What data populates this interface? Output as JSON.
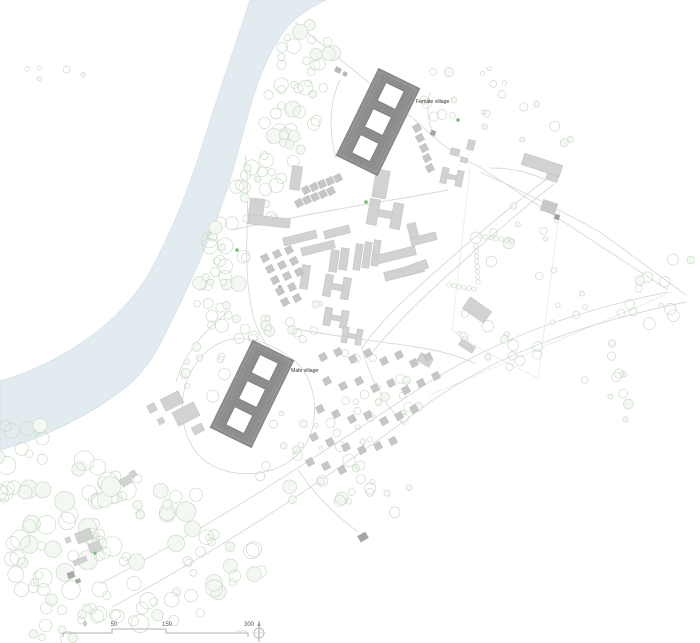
{
  "labels": {
    "female_village": "Female village",
    "male_village": "Male village"
  },
  "label_positions": {
    "female_village": {
      "x": 416,
      "y": 103
    },
    "male_village": {
      "x": 291,
      "y": 372
    }
  },
  "colors": {
    "water": "#e2ebef",
    "water_edge": "#d4e2e8",
    "tree": "#cbdcc8",
    "tree_fill": "#f4f8f2",
    "building": "#d2d2d2",
    "building_edge": "#bfbfbf",
    "hut": "#c6c6c6",
    "village": "#8d8d8d",
    "village_edge": "#7c7c7c",
    "village_inner": "#a3a3a3",
    "courtyard": "#ffffff",
    "road": "#d9d9d9",
    "faint": "#e9e9e9",
    "label_text": "#2e2e2e",
    "scale_text": "#555555",
    "scale_line": "#9a9a9a",
    "north": "#909090",
    "accent_green": "#6fbf6f"
  },
  "scale_bar": {
    "labels": [
      {
        "text": "0",
        "x": 85
      },
      {
        "text": "50",
        "x": 114
      },
      {
        "text": "150",
        "x": 167
      },
      {
        "text": "300",
        "x": 249
      }
    ],
    "label_y": 626,
    "path": "M63,637 L63,633 L112,633 L112,629 L166,629 L166,633 L248,633 L248,637",
    "dash": "M236,631 L247,631"
  },
  "north_arrow": {
    "cx": 259,
    "cy": 633,
    "r": 5
  },
  "map": {
    "water_path": "M250,0 C239,35 222,82 204,140 C188,192 172,230 152,268 C130,308 96,336 60,356 C38,368 18,376 0,381 L0,450 C45,438 90,415 125,388 C152,366 162,340 176,312 C196,270 214,232 230,180 C245,132 252,82 278,40 C288,24 300,12 326,0 Z",
    "villages": [
      {
        "id": "female-village-building",
        "cx": 378,
        "cy": 122,
        "w": 46,
        "h": 97,
        "rot": 26
      },
      {
        "id": "male-village-building",
        "cx": 252,
        "cy": 394,
        "w": 46,
        "h": 97,
        "rot": 26
      }
    ],
    "buildings": [
      {
        "s": "rect",
        "x": 381,
        "y": 184,
        "w": 14,
        "h": 28,
        "r": 10
      },
      {
        "s": "h",
        "x": 385,
        "y": 214,
        "w": 34,
        "h": 26,
        "r": 10
      },
      {
        "s": "l",
        "x": 270,
        "y": 213,
        "w": 42,
        "h": 26,
        "r": 6
      },
      {
        "s": "rect",
        "x": 296,
        "y": 178,
        "w": 10,
        "h": 24,
        "r": 8
      },
      {
        "s": "rect",
        "x": 300,
        "y": 238,
        "w": 34,
        "h": 8,
        "r": -14
      },
      {
        "s": "rect",
        "x": 318,
        "y": 248,
        "w": 34,
        "h": 8,
        "r": -14
      },
      {
        "s": "rect",
        "x": 337,
        "y": 232,
        "w": 26,
        "h": 8,
        "r": -14
      },
      {
        "s": "rect",
        "x": 334,
        "y": 261,
        "w": 8,
        "h": 22,
        "r": 8
      },
      {
        "s": "rect",
        "x": 344,
        "y": 259,
        "w": 8,
        "h": 22,
        "r": 8
      },
      {
        "s": "rect",
        "x": 358,
        "y": 257,
        "w": 7,
        "h": 26,
        "r": 8
      },
      {
        "s": "rect",
        "x": 367,
        "y": 255,
        "w": 7,
        "h": 26,
        "r": 8
      },
      {
        "s": "rect",
        "x": 376,
        "y": 253,
        "w": 7,
        "h": 26,
        "r": 8
      },
      {
        "s": "rect",
        "x": 396,
        "y": 255,
        "w": 40,
        "h": 9,
        "r": -14
      },
      {
        "s": "rect",
        "x": 404,
        "y": 272,
        "w": 40,
        "h": 9,
        "r": -14
      },
      {
        "s": "l",
        "x": 422,
        "y": 232,
        "w": 26,
        "h": 22,
        "r": -14
      },
      {
        "s": "rect",
        "x": 415,
        "y": 268,
        "w": 26,
        "h": 9,
        "r": -20
      },
      {
        "s": "h",
        "x": 337,
        "y": 287,
        "w": 26,
        "h": 22,
        "r": 10
      },
      {
        "s": "h",
        "x": 336,
        "y": 318,
        "w": 24,
        "h": 18,
        "r": 10
      },
      {
        "s": "rect",
        "x": 305,
        "y": 277,
        "w": 8,
        "h": 24,
        "r": 8
      },
      {
        "s": "h",
        "x": 352,
        "y": 336,
        "w": 20,
        "h": 16,
        "r": 10
      },
      {
        "s": "rect",
        "x": 425,
        "y": 360,
        "w": 14,
        "h": 9,
        "r": 30
      },
      {
        "s": "rect",
        "x": 477,
        "y": 310,
        "w": 26,
        "h": 14,
        "r": 35
      },
      {
        "s": "rect",
        "x": 467,
        "y": 346,
        "w": 16,
        "h": 7,
        "r": 32
      },
      {
        "s": "rect",
        "x": 172,
        "y": 401,
        "w": 20,
        "h": 13,
        "r": -27
      },
      {
        "s": "rect",
        "x": 186,
        "y": 414,
        "w": 24,
        "h": 15,
        "r": -27
      },
      {
        "s": "rect",
        "x": 152,
        "y": 408,
        "w": 8,
        "h": 8,
        "r": -27
      },
      {
        "s": "rect",
        "x": 198,
        "y": 429,
        "w": 11,
        "h": 8,
        "r": -27
      },
      {
        "s": "rect",
        "x": 161,
        "y": 421,
        "w": 6,
        "h": 6,
        "r": -27
      },
      {
        "s": "rect",
        "x": 126,
        "y": 481,
        "w": 11,
        "h": 8,
        "r": -30
      },
      {
        "s": "rect",
        "x": 133,
        "y": 474,
        "w": 6,
        "h": 6,
        "r": -30
      },
      {
        "s": "rect",
        "x": 84,
        "y": 536,
        "w": 16,
        "h": 11,
        "r": -22
      },
      {
        "s": "rect",
        "x": 95,
        "y": 547,
        "w": 12,
        "h": 9,
        "r": -22
      },
      {
        "s": "rect",
        "x": 68,
        "y": 540,
        "w": 5,
        "h": 5,
        "r": -22
      },
      {
        "s": "rect",
        "x": 80,
        "y": 561,
        "w": 14,
        "h": 5,
        "r": -22
      },
      {
        "s": "rect",
        "x": 71,
        "y": 575,
        "w": 7,
        "h": 6,
        "r": -20,
        "f": "#a8a8a8"
      },
      {
        "s": "rect",
        "x": 78,
        "y": 581,
        "w": 5,
        "h": 4,
        "r": -20,
        "f": "#a8a8a8"
      },
      {
        "s": "rect",
        "x": 363,
        "y": 537,
        "w": 9,
        "h": 7,
        "r": -30,
        "f": "#a3a3a3"
      },
      {
        "s": "h",
        "x": 452,
        "y": 177,
        "w": 22,
        "h": 16,
        "r": 12
      },
      {
        "s": "rect",
        "x": 455,
        "y": 152,
        "w": 9,
        "h": 7,
        "r": 15
      },
      {
        "s": "rect",
        "x": 464,
        "y": 160,
        "w": 7,
        "h": 5,
        "r": 15
      },
      {
        "s": "rect",
        "x": 471,
        "y": 145,
        "w": 7,
        "h": 10,
        "r": 15
      },
      {
        "s": "rect",
        "x": 542,
        "y": 165,
        "w": 40,
        "h": 12,
        "r": 18
      },
      {
        "s": "rect",
        "x": 552,
        "y": 178,
        "w": 12,
        "h": 6,
        "r": 18
      },
      {
        "s": "rect",
        "x": 549,
        "y": 207,
        "w": 15,
        "h": 11,
        "r": 18,
        "f": "#c8c8c8"
      },
      {
        "s": "rect",
        "x": 557,
        "y": 217,
        "w": 5,
        "h": 5,
        "r": 18,
        "f": "#9e9e9e"
      },
      {
        "s": "rect",
        "x": 433,
        "y": 133,
        "w": 5,
        "h": 5,
        "r": 20,
        "f": "#a5a5a5"
      },
      {
        "s": "rect",
        "x": 338,
        "y": 70,
        "w": 6,
        "h": 5,
        "r": 26,
        "f": "#b8b8b8"
      },
      {
        "s": "rect",
        "x": 345,
        "y": 74,
        "w": 4,
        "h": 4,
        "r": 26,
        "f": "#b8b8b8"
      }
    ],
    "hut_size": 7,
    "hut_rot": -28,
    "huts": [
      [
        306,
        190
      ],
      [
        314,
        187
      ],
      [
        322,
        184
      ],
      [
        330,
        181
      ],
      [
        338,
        178
      ],
      [
        299,
        203
      ],
      [
        307,
        200
      ],
      [
        315,
        197
      ],
      [
        323,
        194
      ],
      [
        331,
        191
      ],
      [
        265,
        258
      ],
      [
        270,
        269
      ],
      [
        275,
        280
      ],
      [
        280,
        291
      ],
      [
        285,
        302
      ],
      [
        277,
        254
      ],
      [
        282,
        265
      ],
      [
        287,
        276
      ],
      [
        292,
        287
      ],
      [
        297,
        298
      ],
      [
        289,
        250
      ],
      [
        294,
        261
      ],
      [
        299,
        272
      ],
      [
        417,
        128
      ],
      [
        420,
        138
      ],
      [
        424,
        148
      ],
      [
        427,
        158
      ],
      [
        430,
        168
      ],
      [
        323,
        357
      ],
      [
        338,
        352
      ],
      [
        353,
        359
      ],
      [
        368,
        353
      ],
      [
        384,
        361
      ],
      [
        399,
        355
      ],
      [
        414,
        363
      ],
      [
        428,
        357
      ],
      [
        327,
        381
      ],
      [
        343,
        386
      ],
      [
        359,
        381
      ],
      [
        375,
        388
      ],
      [
        391,
        383
      ],
      [
        406,
        390
      ],
      [
        421,
        383
      ],
      [
        436,
        376
      ],
      [
        320,
        409
      ],
      [
        336,
        414
      ],
      [
        352,
        419
      ],
      [
        368,
        415
      ],
      [
        384,
        421
      ],
      [
        399,
        416
      ],
      [
        414,
        409
      ],
      [
        314,
        437
      ],
      [
        330,
        442
      ],
      [
        346,
        447
      ],
      [
        362,
        450
      ],
      [
        378,
        446
      ],
      [
        393,
        441
      ],
      [
        310,
        462
      ],
      [
        326,
        466
      ],
      [
        342,
        470
      ]
    ],
    "tree_clusters": [
      [
        312,
        62,
        34,
        40,
        22,
        3,
        8
      ],
      [
        288,
        122,
        30,
        40,
        22,
        3,
        8
      ],
      [
        258,
        188,
        26,
        38,
        20,
        3,
        8
      ],
      [
        232,
        250,
        24,
        36,
        18,
        3,
        8
      ],
      [
        214,
        302,
        22,
        28,
        14,
        3,
        7
      ],
      [
        248,
        332,
        28,
        20,
        10,
        2,
        6
      ],
      [
        55,
        490,
        60,
        45,
        26,
        4,
        10
      ],
      [
        140,
        515,
        65,
        45,
        26,
        4,
        10
      ],
      [
        60,
        565,
        60,
        45,
        24,
        4,
        10
      ],
      [
        150,
        588,
        70,
        38,
        22,
        4,
        9
      ],
      [
        228,
        560,
        45,
        35,
        16,
        3,
        8
      ],
      [
        90,
        622,
        80,
        20,
        14,
        3,
        8
      ],
      [
        22,
        442,
        30,
        28,
        10,
        3,
        8
      ],
      [
        208,
        370,
        32,
        28,
        10,
        2,
        6
      ],
      [
        300,
        322,
        38,
        22,
        8,
        2,
        5
      ],
      [
        352,
        400,
        68,
        48,
        14,
        2,
        5
      ],
      [
        312,
        478,
        55,
        35,
        12,
        3,
        7
      ],
      [
        382,
        490,
        48,
        28,
        10,
        2,
        6
      ],
      [
        400,
        400,
        60,
        22,
        12,
        2,
        5
      ],
      [
        520,
        250,
        60,
        48,
        10,
        2,
        6
      ],
      [
        600,
        300,
        70,
        48,
        10,
        2,
        6
      ],
      [
        658,
        268,
        38,
        55,
        8,
        2,
        6
      ],
      [
        560,
        350,
        60,
        38,
        8,
        2,
        5
      ],
      [
        488,
        340,
        45,
        32,
        10,
        2,
        6
      ],
      [
        622,
        388,
        48,
        32,
        7,
        2,
        5
      ],
      [
        545,
        122,
        38,
        28,
        6,
        2,
        5
      ],
      [
        472,
        82,
        38,
        24,
        6,
        2,
        5
      ],
      [
        432,
        95,
        24,
        24,
        6,
        2,
        5
      ],
      [
        60,
        70,
        40,
        14,
        5,
        2,
        4
      ],
      [
        300,
        432,
        28,
        26,
        6,
        2,
        5
      ],
      [
        468,
        120,
        20,
        18,
        4,
        2,
        4
      ]
    ],
    "hedges": [
      [
        480,
        236,
        512,
        241,
        7
      ],
      [
        476,
        246,
        478,
        282,
        8
      ],
      [
        449,
        285,
        474,
        289,
        6
      ]
    ],
    "accent_dots": [
      [
        366,
        202
      ],
      [
        458,
        120
      ],
      [
        95,
        553
      ],
      [
        237,
        250
      ],
      [
        280,
        287
      ]
    ],
    "roads": [
      "M295,22 C340,60 385,95 415,120 C438,142 458,158 478,166 L668,290",
      "M480,172 C520,190 560,210 600,232 L686,295",
      "M100,584 C200,532 300,468 420,388 C500,336 580,310 668,292",
      "M112,607 C212,554 312,490 430,402 C505,350 590,322 686,302",
      "M362,348 C380,320 420,285 460,250 C495,220 525,195 548,178",
      "M370,356 C390,328 428,292 468,257 C500,228 530,203 554,184",
      "M245,155 C252,200 242,250 250,300 C254,328 264,346 280,358",
      "M232,230 C280,220 330,210 380,202 C410,197 432,193 448,190",
      "M292,328 C330,336 370,340 410,346 C438,350 460,356 476,364",
      "M214,346 C180,368 172,420 196,452 C220,482 276,480 300,452 C322,428 318,382 296,362 C272,342 240,330 214,346",
      "M228,312 C205,330 185,352 176,382",
      "M362,348 C370,380 385,405 405,425",
      "M298,470 C315,495 335,515 358,532",
      "M430,92 C426,108 428,122 433,133",
      "M340,80 C330,100 328,130 336,158",
      "M545,180 C530,172 510,168 490,168"
    ],
    "faint_lines": [
      "M470,168 L452,330",
      "M560,208 L538,378",
      "M452,330 C480,350 510,365 538,378",
      "M430,395 L672,292"
    ]
  }
}
